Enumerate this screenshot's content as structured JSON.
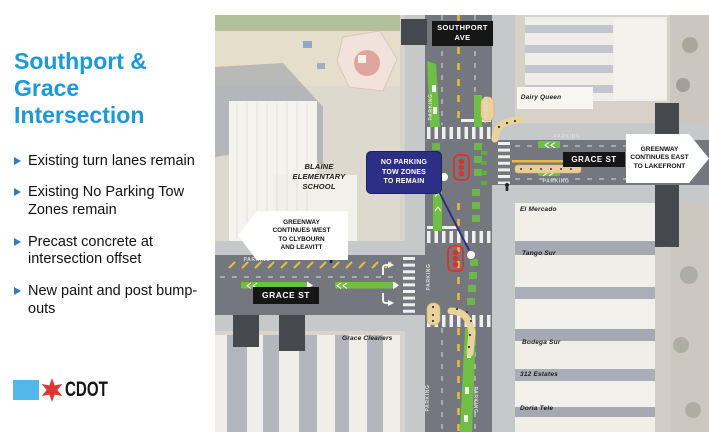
{
  "colors": {
    "accent_blue": "#1B9AD7",
    "bullet_blue": "#2F7CC0",
    "navy_callout": "#2D2F86",
    "road_gray": "#74787E",
    "bike_green": "#6FBF44",
    "lane_yellow": "#E9BC3F",
    "bumpout_tan": "#EBD29B",
    "tow_zone_red": "#D9342B",
    "logo_blue": "#53B7E8",
    "logo_red": "#E23434"
  },
  "left_panel": {
    "title_lines": [
      "Southport &",
      "Grace",
      "Intersection"
    ],
    "bullets": [
      "Existing turn lanes remain",
      "Existing No Parking Tow Zones remain",
      "Precast concrete at intersection offset",
      "New paint and post bump-outs"
    ],
    "logo_text": "CDOT"
  },
  "map": {
    "street_labels": {
      "southport_line1": "SOUTHPORT",
      "southport_line2": "AVE",
      "grace_east": "GRACE ST",
      "grace_west": "GRACE ST"
    },
    "parking_label": "PARKING",
    "callouts": {
      "east": {
        "lines": [
          "GREENWAY",
          "CONTINUES EAST",
          "TO LAKEFRONT"
        ]
      },
      "west": {
        "lines": [
          "GREENWAY",
          "CONTINUES WEST",
          "TO CLYBOURN",
          "AND LEAVITT"
        ]
      },
      "no_parking": {
        "lines": [
          "NO PARKING",
          "TOW ZONES",
          "TO REMAIN"
        ]
      }
    },
    "buildings": {
      "blaine_lines": [
        "BLAINE",
        "ELEMENTARY",
        "SCHOOL"
      ],
      "dairy_queen": "Dairy Queen",
      "el_mercado": "El Mercado",
      "tango_sur": "Tango Sur",
      "bodega_sur": "Bodega Sur",
      "estates": "312 Estates",
      "doria": "Doria Tele",
      "grace_cleaners": "Grace Cleaners"
    }
  }
}
